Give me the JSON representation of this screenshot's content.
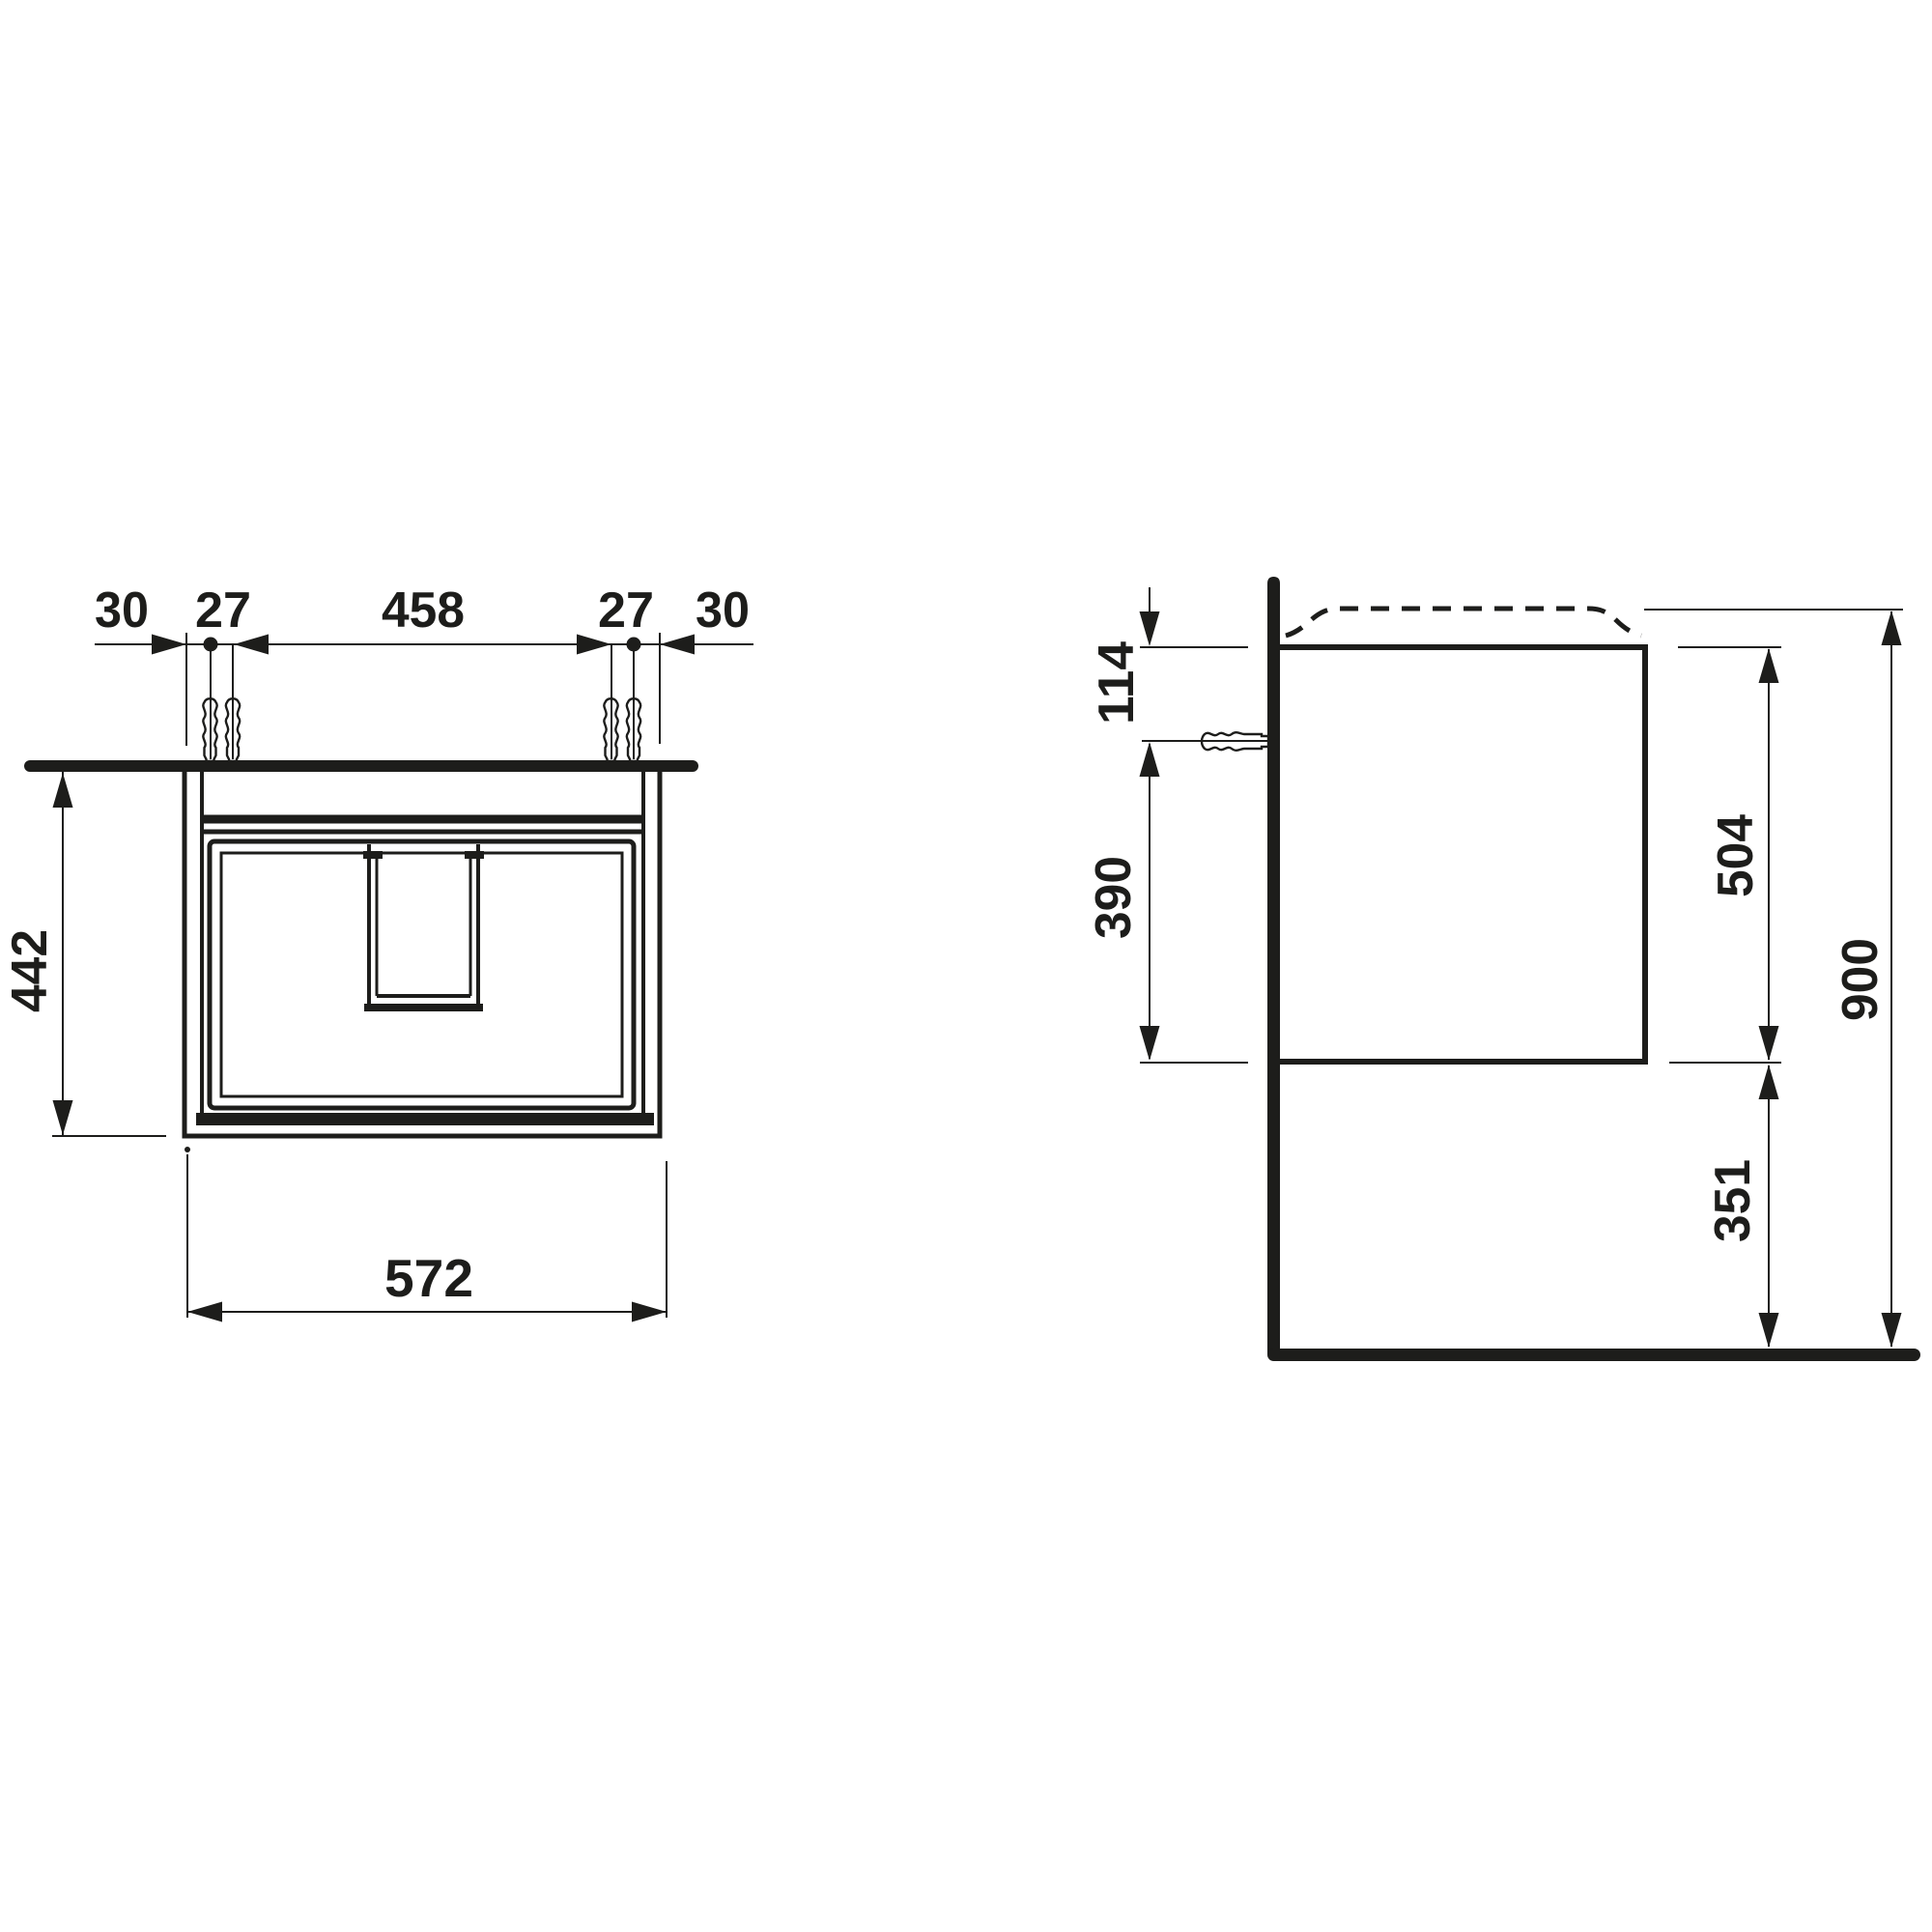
{
  "colors": {
    "ink": "#1d1d1b",
    "background": "#ffffff"
  },
  "front_view": {
    "dimensions": {
      "overhang_left": "30",
      "hole_gap_left": "27",
      "hole_span": "458",
      "hole_gap_right": "27",
      "overhang_right": "30",
      "body_height": "442",
      "body_width": "572"
    }
  },
  "side_view": {
    "dimensions": {
      "top_to_fixing": "114",
      "fixing_to_bottom": "390",
      "body_height": "504",
      "total_height": "900",
      "floor_clearance": "351"
    }
  },
  "icons": {
    "wall_plug": "wall-plug-icon"
  }
}
